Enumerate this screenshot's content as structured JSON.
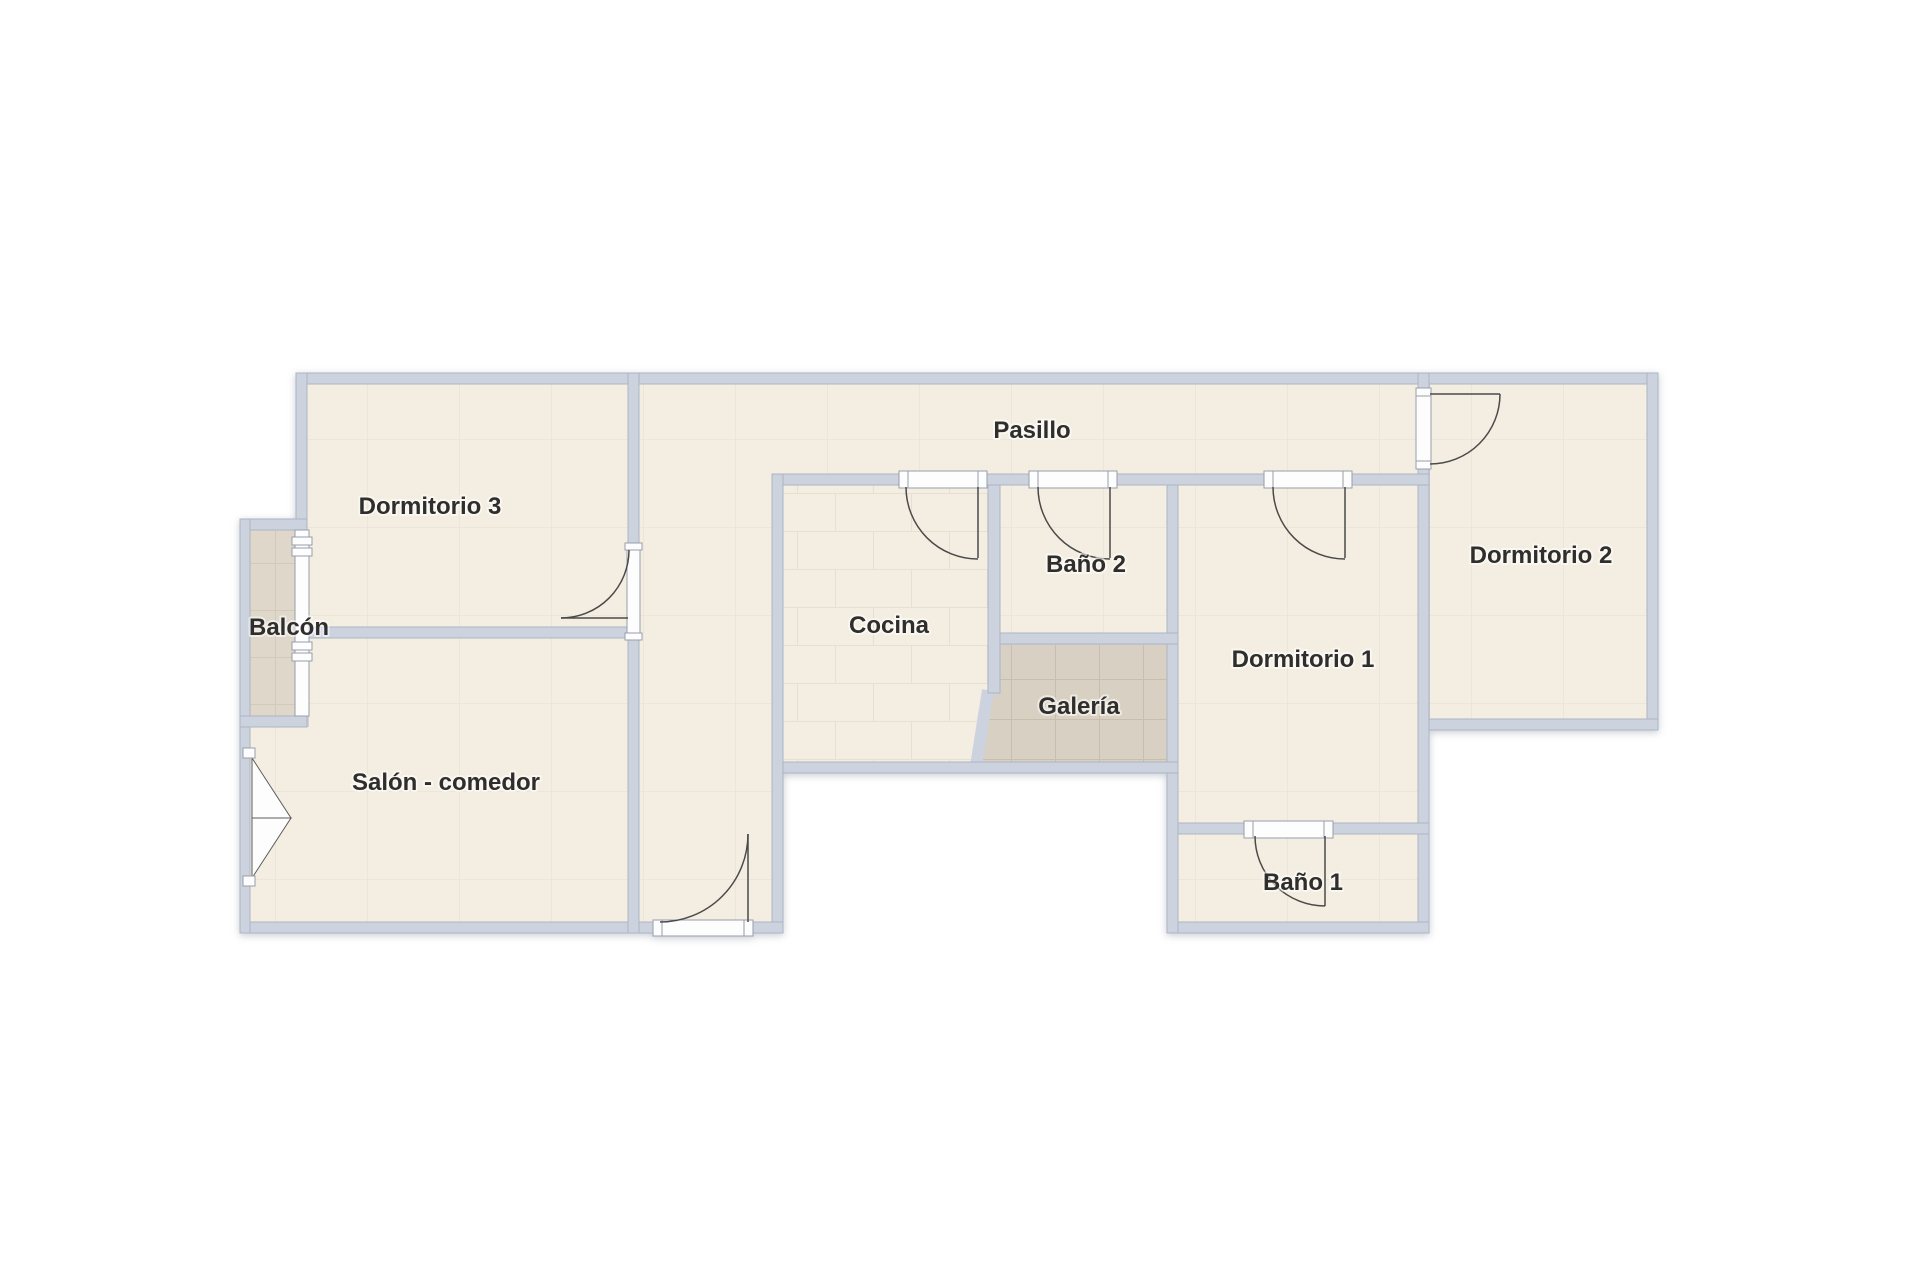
{
  "plan": {
    "type": "apartment-floor-plan",
    "rooms": [
      {
        "id": "pasillo",
        "label": "Pasillo"
      },
      {
        "id": "dormitorio-3",
        "label": "Dormitorio 3"
      },
      {
        "id": "balcon",
        "label": "Balcón"
      },
      {
        "id": "salon-comedor",
        "label": "Salón - comedor"
      },
      {
        "id": "cocina",
        "label": "Cocina"
      },
      {
        "id": "bano-2",
        "label": "Baño 2"
      },
      {
        "id": "galeria",
        "label": "Galería"
      },
      {
        "id": "dormitorio-1",
        "label": "Dormitorio 1"
      },
      {
        "id": "bano-1",
        "label": "Baño 1"
      },
      {
        "id": "dormitorio-2",
        "label": "Dormitorio 2"
      }
    ],
    "features": {
      "interior_door_count": 6,
      "entrance_door_count": 1,
      "balcony_window_count": 2,
      "french_window_count": 1
    },
    "colors": {
      "background": "#ffffff",
      "wall_fill": "#ccd3df",
      "wall_outline": "#aeb5c3",
      "floor": "#f3eee1",
      "tile_floor": "#d8d0c2",
      "balcony_floor": "#ded7ca",
      "door_line": "#4a4a4a",
      "frame_white": "#fdfdfd",
      "label_text": "#2f2e2d"
    }
  }
}
